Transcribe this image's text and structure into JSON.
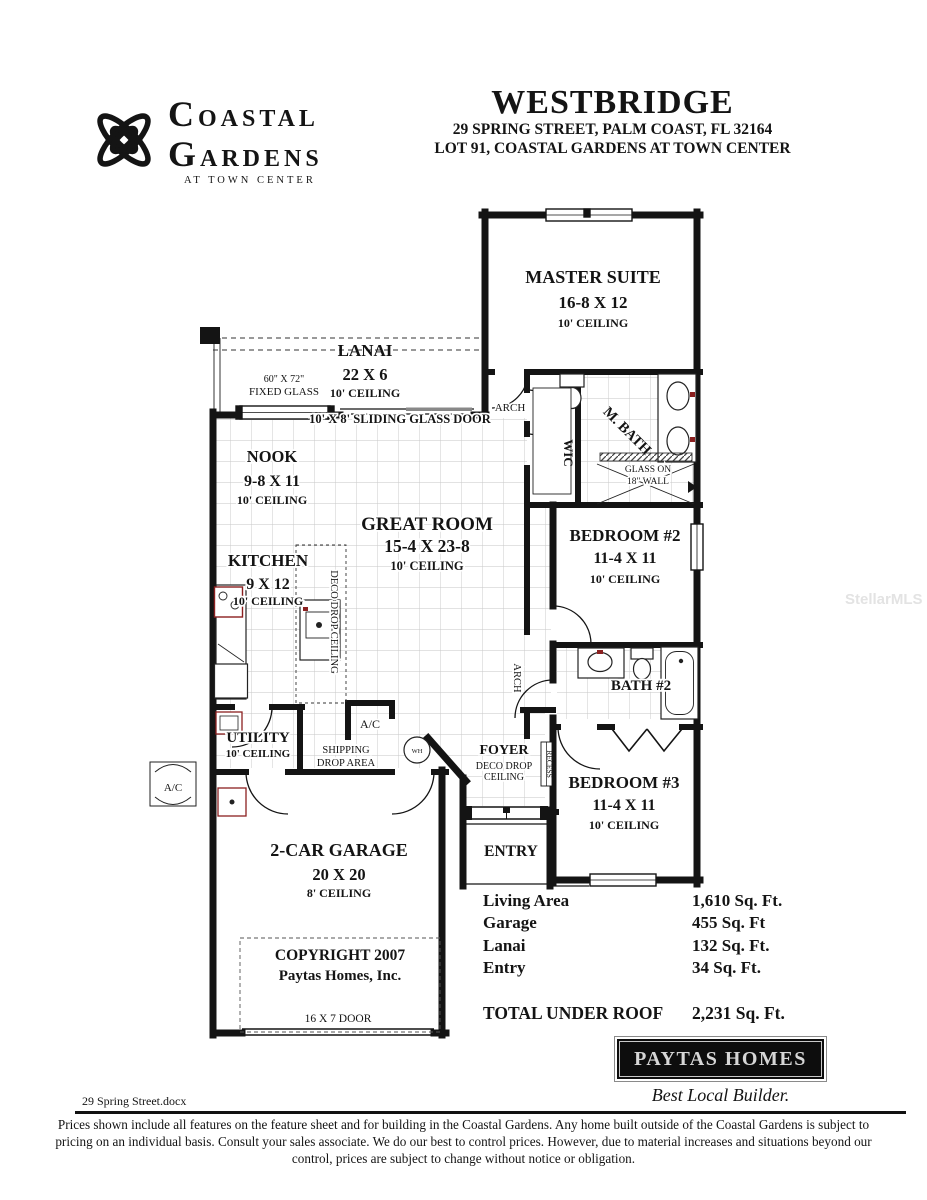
{
  "header": {
    "logo_line1": "COASTAL",
    "logo_line2": "GARDENS",
    "logo_line3": "AT TOWN CENTER",
    "title": "WESTBRIDGE",
    "address_line1": "29 SPRING STREET, PALM COAST, FL 32164",
    "address_line2": "LOT 91, COASTAL GARDENS AT TOWN CENTER"
  },
  "plan": {
    "master": {
      "name": "MASTER SUITE",
      "dims": "16-8 X 12",
      "ceiling": "10' CEILING"
    },
    "lanai": {
      "name": "LANAI",
      "dims": "22 X 6",
      "ceiling": "10' CEILING"
    },
    "nook": {
      "name": "NOOK",
      "dims": "9-8 X 11",
      "ceiling": "10' CEILING"
    },
    "great_room": {
      "name": "GREAT ROOM",
      "dims": "15-4 X 23-8",
      "ceiling": "10' CEILING"
    },
    "kitchen": {
      "name": "KITCHEN",
      "dims": "9 X 12",
      "ceiling": "10' CEILING"
    },
    "bedroom2": {
      "name": "BEDROOM #2",
      "dims": "11-4 X 11",
      "ceiling": "10' CEILING"
    },
    "bedroom3": {
      "name": "BEDROOM #3",
      "dims": "11-4 X 11",
      "ceiling": "10' CEILING"
    },
    "bath2": {
      "name": "BATH #2"
    },
    "master_bath": {
      "name": "M. BATH"
    },
    "wic": {
      "name": "WIC"
    },
    "utility": {
      "name": "UTILITY",
      "ceiling": "10' CEILING"
    },
    "foyer": {
      "name": "FOYER",
      "note_line1": "DECO DROP",
      "note_line2": "CEILING"
    },
    "entry": {
      "name": "ENTRY"
    },
    "garage": {
      "name": "2-CAR GARAGE",
      "dims": "20 X 20",
      "ceiling": "8' CEILING"
    },
    "annotations": {
      "fixed_glass_size": "60\" X 72\"",
      "fixed_glass": "FIXED GLASS",
      "sliding_door": "10' X 8' SLIDING GLASS DOOR",
      "arch_hall": "ARCH",
      "arch_bedroom_hall": "ARCH",
      "glass_on": "GLASS ON",
      "wall_18": "18\" WALL",
      "deco_drop_ceiling": "DECO DROP CEILING",
      "recess": "RECESS",
      "shipping": "SHIPPING",
      "drop_area": "DROP AREA",
      "ac_closet": "A/C",
      "ac_pad": "A/C",
      "water_heater": "WH",
      "garage_door": "16 X 7 DOOR",
      "copyright_line1": "COPYRIGHT 2007",
      "copyright_line2": "Paytas Homes, Inc."
    }
  },
  "stats": {
    "rows": [
      {
        "label": "Living Area",
        "value": "1,610 Sq. Ft."
      },
      {
        "label": "Garage",
        "value": "455 Sq. Ft"
      },
      {
        "label": "Lanai",
        "value": "132 Sq. Ft."
      },
      {
        "label": "Entry",
        "value": "34 Sq. Ft."
      }
    ],
    "total_label": "TOTAL UNDER ROOF",
    "total_value": "2,231 Sq. Ft."
  },
  "builder": {
    "name": "PAYTAS HOMES",
    "tagline": "Best Local Builder."
  },
  "footer": {
    "filename": "29 Spring Street.docx",
    "disclaimer": "Prices shown include all features on the feature sheet and for building in the Coastal Gardens.  Any home built outside of the Coastal Gardens is subject to pricing on an individual basis.  Consult your sales associate.  We do our best to control prices.  However, due to material increases and situations beyond our control, prices are subject to change without notice or obligation."
  },
  "watermark": "StellarMLS"
}
